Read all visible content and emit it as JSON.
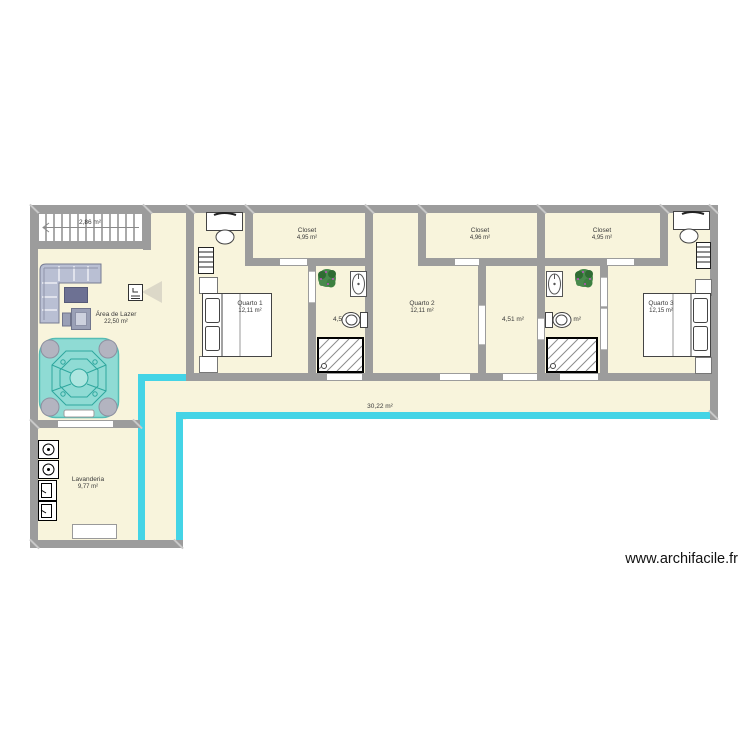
{
  "watermark": "www.archifacile.fr",
  "colors": {
    "wall": "#9c9c9c",
    "floor": "#f8f4dc",
    "accent": "#44d4e6",
    "ink": "#3a3a3a",
    "tub": "#8fdbd4",
    "tubline": "#2fa79e",
    "sofa": "#b9bfd3",
    "sofaline": "#767b92"
  },
  "rooms": {
    "stairs": {
      "area": "2,86 m²"
    },
    "area_lazer": {
      "name": "Área de Lazer",
      "area": "22,50 m²"
    },
    "lavanderia": {
      "name": "Lavanderia",
      "area": "9,77 m²"
    },
    "corridor": {
      "area": "30,22 m²"
    },
    "quarto1": {
      "name": "Quarto 1",
      "area": "12,11 m²"
    },
    "quarto2": {
      "name": "Quarto 2",
      "area": "12,11 m²"
    },
    "quarto3": {
      "name": "Quarto 3",
      "area": "12,15 m²"
    },
    "closet1": {
      "name": "Closet",
      "area": "4,95 m²"
    },
    "closet2": {
      "name": "Closet",
      "area": "4,96 m²"
    },
    "closet3": {
      "name": "Closet",
      "area": "4,95 m²"
    },
    "bath1": {
      "area": "4,51 m²"
    },
    "middle_room": {
      "area": "4,51 m²"
    },
    "bath3": {
      "area": "4,51 m²"
    }
  },
  "icons": [
    "stairs-icon",
    "sofa-icon",
    "coffee-table-icon",
    "side-table-icon",
    "tv-icon",
    "hot-tub-icon",
    "bed-icon",
    "desk-icon",
    "chair-icon",
    "dresser-icon",
    "plant-icon",
    "sink-icon",
    "toilet-icon",
    "shower-icon",
    "washer-icon",
    "dryer-icon",
    "cabinet-icon",
    "door-opening"
  ]
}
